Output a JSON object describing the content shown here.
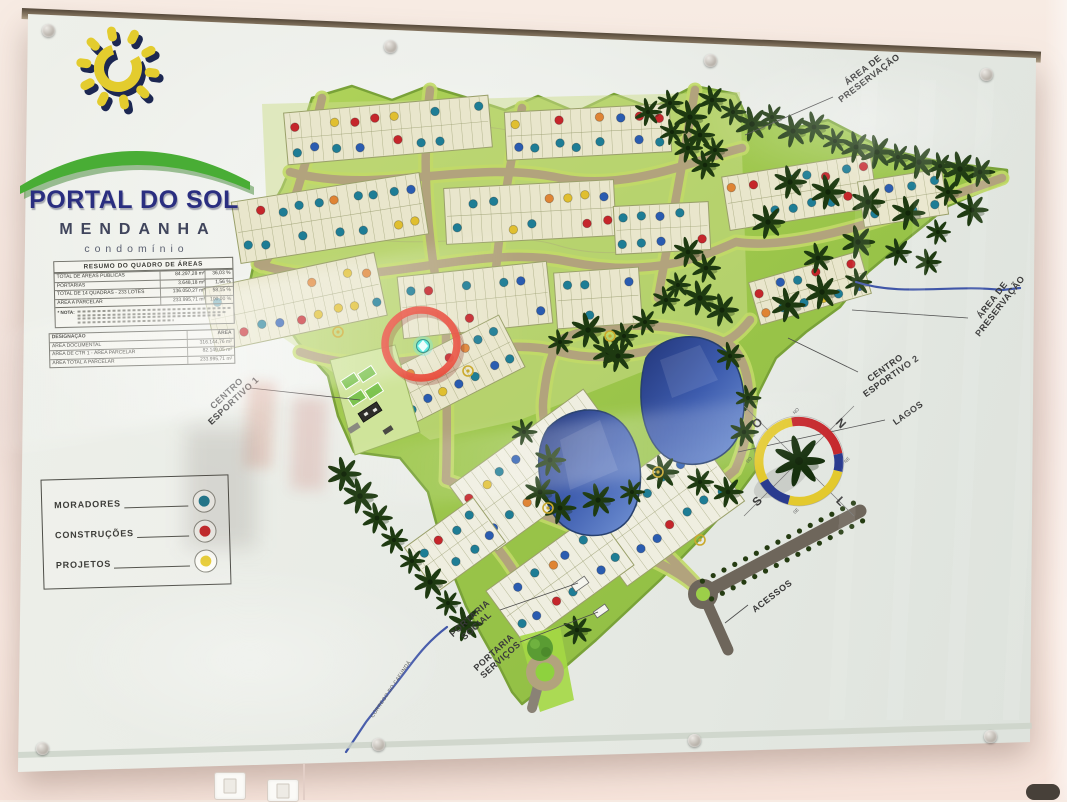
{
  "board": {
    "logo": {
      "title": "PORTAL DO SOL",
      "subtitle": "MENDANHA",
      "tagline": "condomínio"
    },
    "area_table": {
      "title": "RESUMO DO QUADRO DE ÁREAS",
      "rows": [
        {
          "label": "TOTAL DE ÁREAS PÚBLICAS",
          "area": "84.297,28 m²",
          "pct": "36,03 %"
        },
        {
          "label": "PORTARIAS",
          "area": "3.648,18 m²",
          "pct": "1,56 %"
        },
        {
          "label": "TOTAL DE 14 QUADRAS - 233 LOTES",
          "area": "136.050,27 m²",
          "pct": "58,15 %"
        },
        {
          "label": "ÁREA A PARCELAR",
          "area": "233.995,71 m²",
          "pct": "100,00 %"
        }
      ],
      "note_label": "* NOTA:"
    },
    "designation_table": {
      "headers": [
        "DESIGNAÇÃO",
        "ÁREA"
      ],
      "rows": [
        {
          "label": "ÁREA DOCUMENTAL",
          "area": "316.144,76 m²"
        },
        {
          "label": "ÁREA DE CTR 1 - ÁREA PARCELAR",
          "area": "82.149,05 m²"
        },
        {
          "label": "ÁREA TOTAL A PARCELAR",
          "area": "233.995,71 m²"
        }
      ]
    },
    "legend": {
      "items": [
        {
          "label": "MORADORES",
          "color": "#1e7d95"
        },
        {
          "label": "CONSTRUÇÕES",
          "color": "#d0262a"
        },
        {
          "label": "PROJETOS",
          "color": "#e9cf3b"
        }
      ]
    },
    "map_labels": [
      {
        "lines": [
          "ÁREA DE",
          "PRESERVAÇÃO"
        ]
      },
      {
        "lines": [
          "ÁREA DE",
          "PRESERVAÇÃO"
        ]
      },
      {
        "lines": [
          "CENTRO",
          "ESPORTIVO 2"
        ]
      },
      {
        "lines": [
          "LAGOS"
        ]
      },
      {
        "lines": [
          "CENTRO",
          "ESPORTIVO 1"
        ]
      },
      {
        "lines": [
          "PORTARIA",
          "SOCIAL"
        ]
      },
      {
        "lines": [
          "PORTARIA",
          "SERVIÇOS"
        ]
      },
      {
        "lines": [
          "ACESSOS"
        ]
      }
    ],
    "compass": {
      "cardinals": [
        "O",
        "N",
        "S",
        "L"
      ],
      "ticks": [
        "NO",
        "NE",
        "SO",
        "SE"
      ]
    },
    "stream_label": "CÓRREGO DO CAFUNDÁ",
    "colors": {
      "dot_teal": "#1e7d95",
      "dot_blue": "#2a5cb0",
      "dot_red": "#c5262b",
      "dot_yellow": "#e0bf30",
      "dot_orange": "#df8434",
      "highlight_circle": "#e84b3a",
      "highlight_marker": "#49e8dc",
      "palm": "#1e3a11",
      "road": "#b2a37d",
      "verge": "#c2da68",
      "access_road": "#6e665b"
    }
  }
}
